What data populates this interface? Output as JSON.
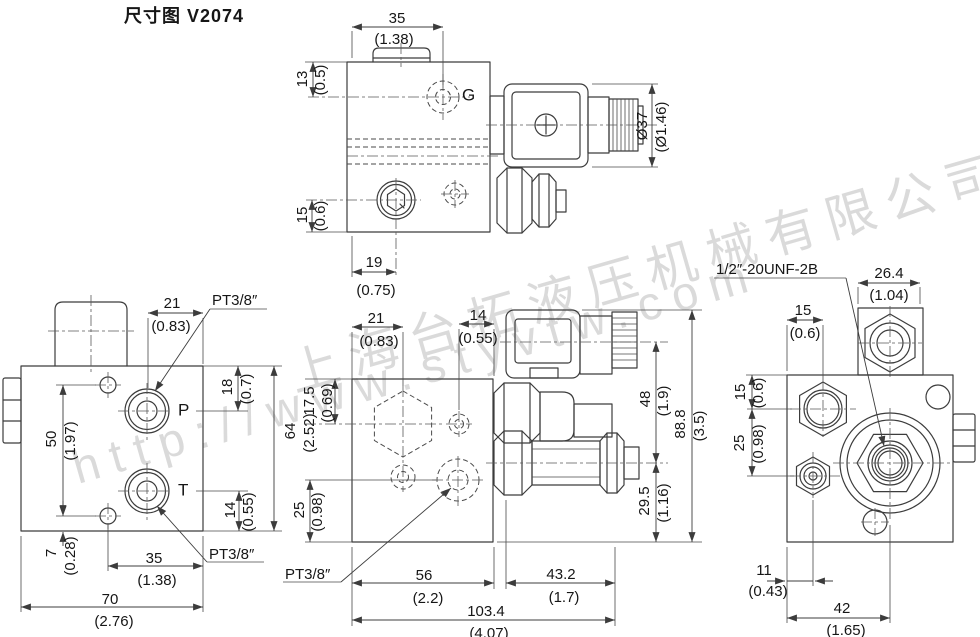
{
  "title": "尺寸图 V2074",
  "watermark": {
    "company": "上海台拓液压机械有限公司",
    "url": "http://www.styvtw.com"
  },
  "colors": {
    "line": "#3c3c3c",
    "text": "#161616",
    "watermark": "#cccccc",
    "background": "#ffffff"
  },
  "top_view": {
    "dim_35": {
      "mm": "35",
      "in": "(1.38)"
    },
    "dim_13": {
      "mm": "13",
      "in": "(0.5)"
    },
    "dim_15": {
      "mm": "15",
      "in": "(0.6)"
    },
    "dim_19": {
      "mm": "19",
      "in": "(0.75)"
    },
    "dim_dia_37": {
      "mm": "Ø37",
      "in": "(Ø1.46)"
    },
    "port_g": "G"
  },
  "front_view": {
    "dim_21": {
      "mm": "21",
      "in": "(0.83)"
    },
    "dim_18": {
      "mm": "18",
      "in": "(0.7)"
    },
    "dim_64": {
      "mm": "64",
      "in": "(2.52)"
    },
    "dim_50": {
      "mm": "50",
      "in": "(1.97)"
    },
    "dim_14": {
      "mm": "14",
      "in": "(0.55)"
    },
    "dim_7": {
      "mm": "7",
      "in": "(0.28)"
    },
    "dim_35": {
      "mm": "35",
      "in": "(1.38)"
    },
    "dim_70": {
      "mm": "70",
      "in": "(2.76)"
    },
    "port_p": "P",
    "port_t": "T",
    "thread_p": "PT3/8″",
    "thread_t": "PT3/8″"
  },
  "side_view": {
    "dim_21": {
      "mm": "21",
      "in": "(0.83)"
    },
    "dim_14": {
      "mm": "14",
      "in": "(0.55)"
    },
    "dim_17_5": {
      "mm": "17.5",
      "in": "(0.69)"
    },
    "dim_48": {
      "mm": "48",
      "in": "(1.9)"
    },
    "dim_88_8": {
      "mm": "88.8",
      "in": "(3.5)"
    },
    "dim_25": {
      "mm": "25",
      "in": "(0.98)"
    },
    "dim_29_5": {
      "mm": "29.5",
      "in": "(1.16)"
    },
    "dim_56": {
      "mm": "56",
      "in": "(2.2)"
    },
    "dim_43_2": {
      "mm": "43.2",
      "in": "(1.7)"
    },
    "dim_103_4": {
      "mm": "103.4",
      "in": "(4.07)"
    },
    "thread_port": "PT3/8″"
  },
  "end_view": {
    "thread_spec": "1/2″-20UNF-2B",
    "dim_26_4": {
      "mm": "26.4",
      "in": "(1.04)"
    },
    "dim_15_top": {
      "mm": "15",
      "in": "(0.6)"
    },
    "dim_15_side": {
      "mm": "15",
      "in": "(0.6)"
    },
    "dim_25": {
      "mm": "25",
      "in": "(0.98)"
    },
    "dim_11": {
      "mm": "11",
      "in": "(0.43)"
    },
    "dim_42": {
      "mm": "42",
      "in": "(1.65)"
    }
  }
}
